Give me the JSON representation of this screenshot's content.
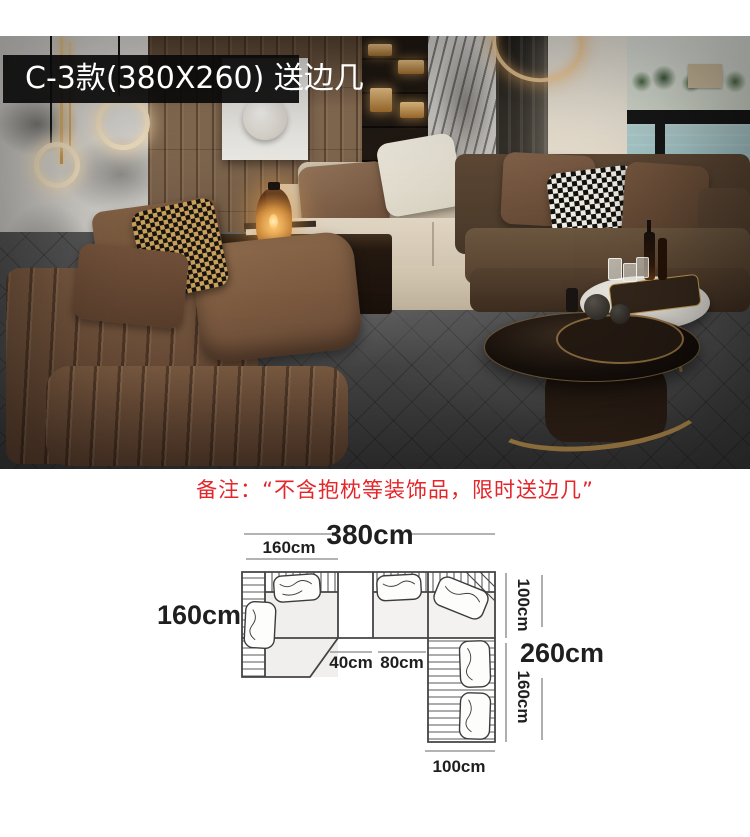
{
  "badge": {
    "label": "C-3款(380X260) 送边几"
  },
  "note": {
    "text": "备注：“不含抱枕等装饰品，限时送边几”"
  },
  "diagram": {
    "total_width": "380cm",
    "left_chaise_width": "160cm",
    "left_side_depth": "160cm",
    "right_upper_depth": "100cm",
    "right_total_depth": "260cm",
    "right_lower_length": "160cm",
    "corner_table_width": "40cm",
    "middle_seat_width": "80cm",
    "right_section_width": "100cm"
  },
  "colors": {
    "badge_bg": "#0a0a0a",
    "badge_text": "#ffffff",
    "note_red": "#e4252a",
    "water_teal": "#58a0ad",
    "sofa_brown": "#7e5d43",
    "sofa_beige": "#d4c8b2",
    "sofa_dark_brown": "#5f4936",
    "carpet_gray": "#4c4c4c",
    "gold_accent": "#b68e4e",
    "diagram_outline": "#444444",
    "diagram_dim_line": "#999999"
  }
}
